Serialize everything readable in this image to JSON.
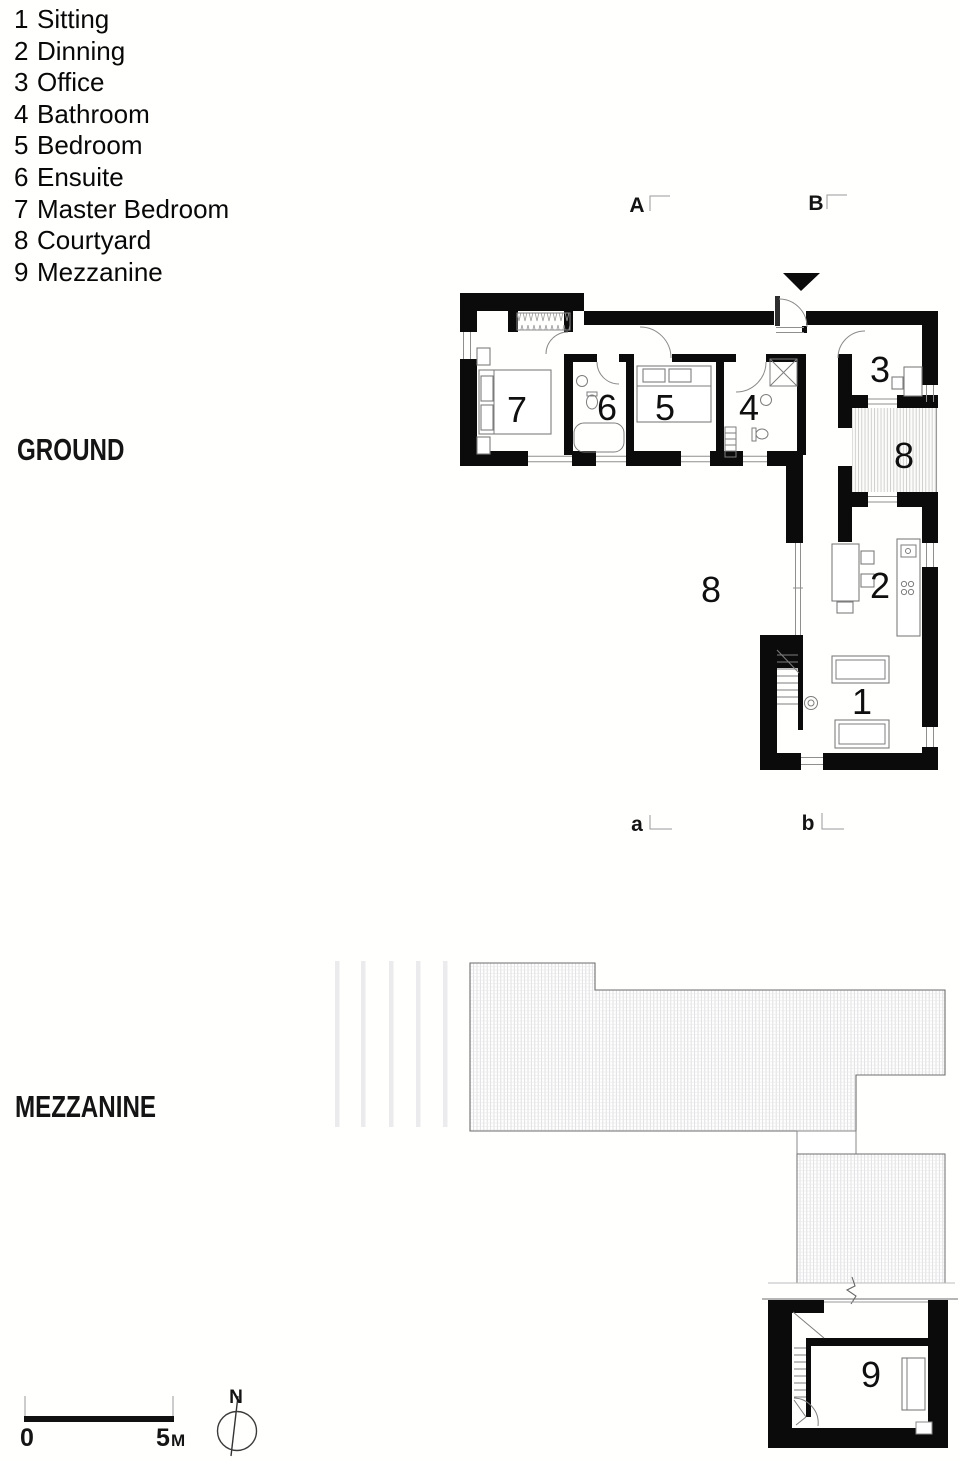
{
  "legend": {
    "items": [
      {
        "number": "1",
        "label": "Sitting"
      },
      {
        "number": "2",
        "label": "Dinning"
      },
      {
        "number": "3",
        "label": "Office"
      },
      {
        "number": "4",
        "label": "Bathroom"
      },
      {
        "number": "5",
        "label": "Bedroom"
      },
      {
        "number": "6",
        "label": "Ensuite"
      },
      {
        "number": "7",
        "label": "Master Bedroom"
      },
      {
        "number": "8",
        "label": "Courtyard"
      },
      {
        "number": "9",
        "label": "Mezzanine"
      }
    ]
  },
  "floor_labels": {
    "ground": "GROUND",
    "mezzanine": "MEZZANINE"
  },
  "section_markers": {
    "top_left": "A",
    "top_right": "B",
    "bottom_left": "a",
    "bottom_right": "b"
  },
  "room_numbers": {
    "sitting": "1",
    "dinning": "2",
    "office": "3",
    "bathroom": "4",
    "bedroom": "5",
    "ensuite": "6",
    "master_bedroom": "7",
    "courtyard": "8",
    "mezzanine": "9"
  },
  "scale_bar": {
    "zero": "0",
    "length_value": "5",
    "length_unit": "M"
  },
  "compass": {
    "north": "N"
  },
  "colors": {
    "wall": "#000000",
    "deck_hatch": "#c6c6c6",
    "roof_hatch": "#d2d2d6",
    "annotation": "#111111"
  }
}
